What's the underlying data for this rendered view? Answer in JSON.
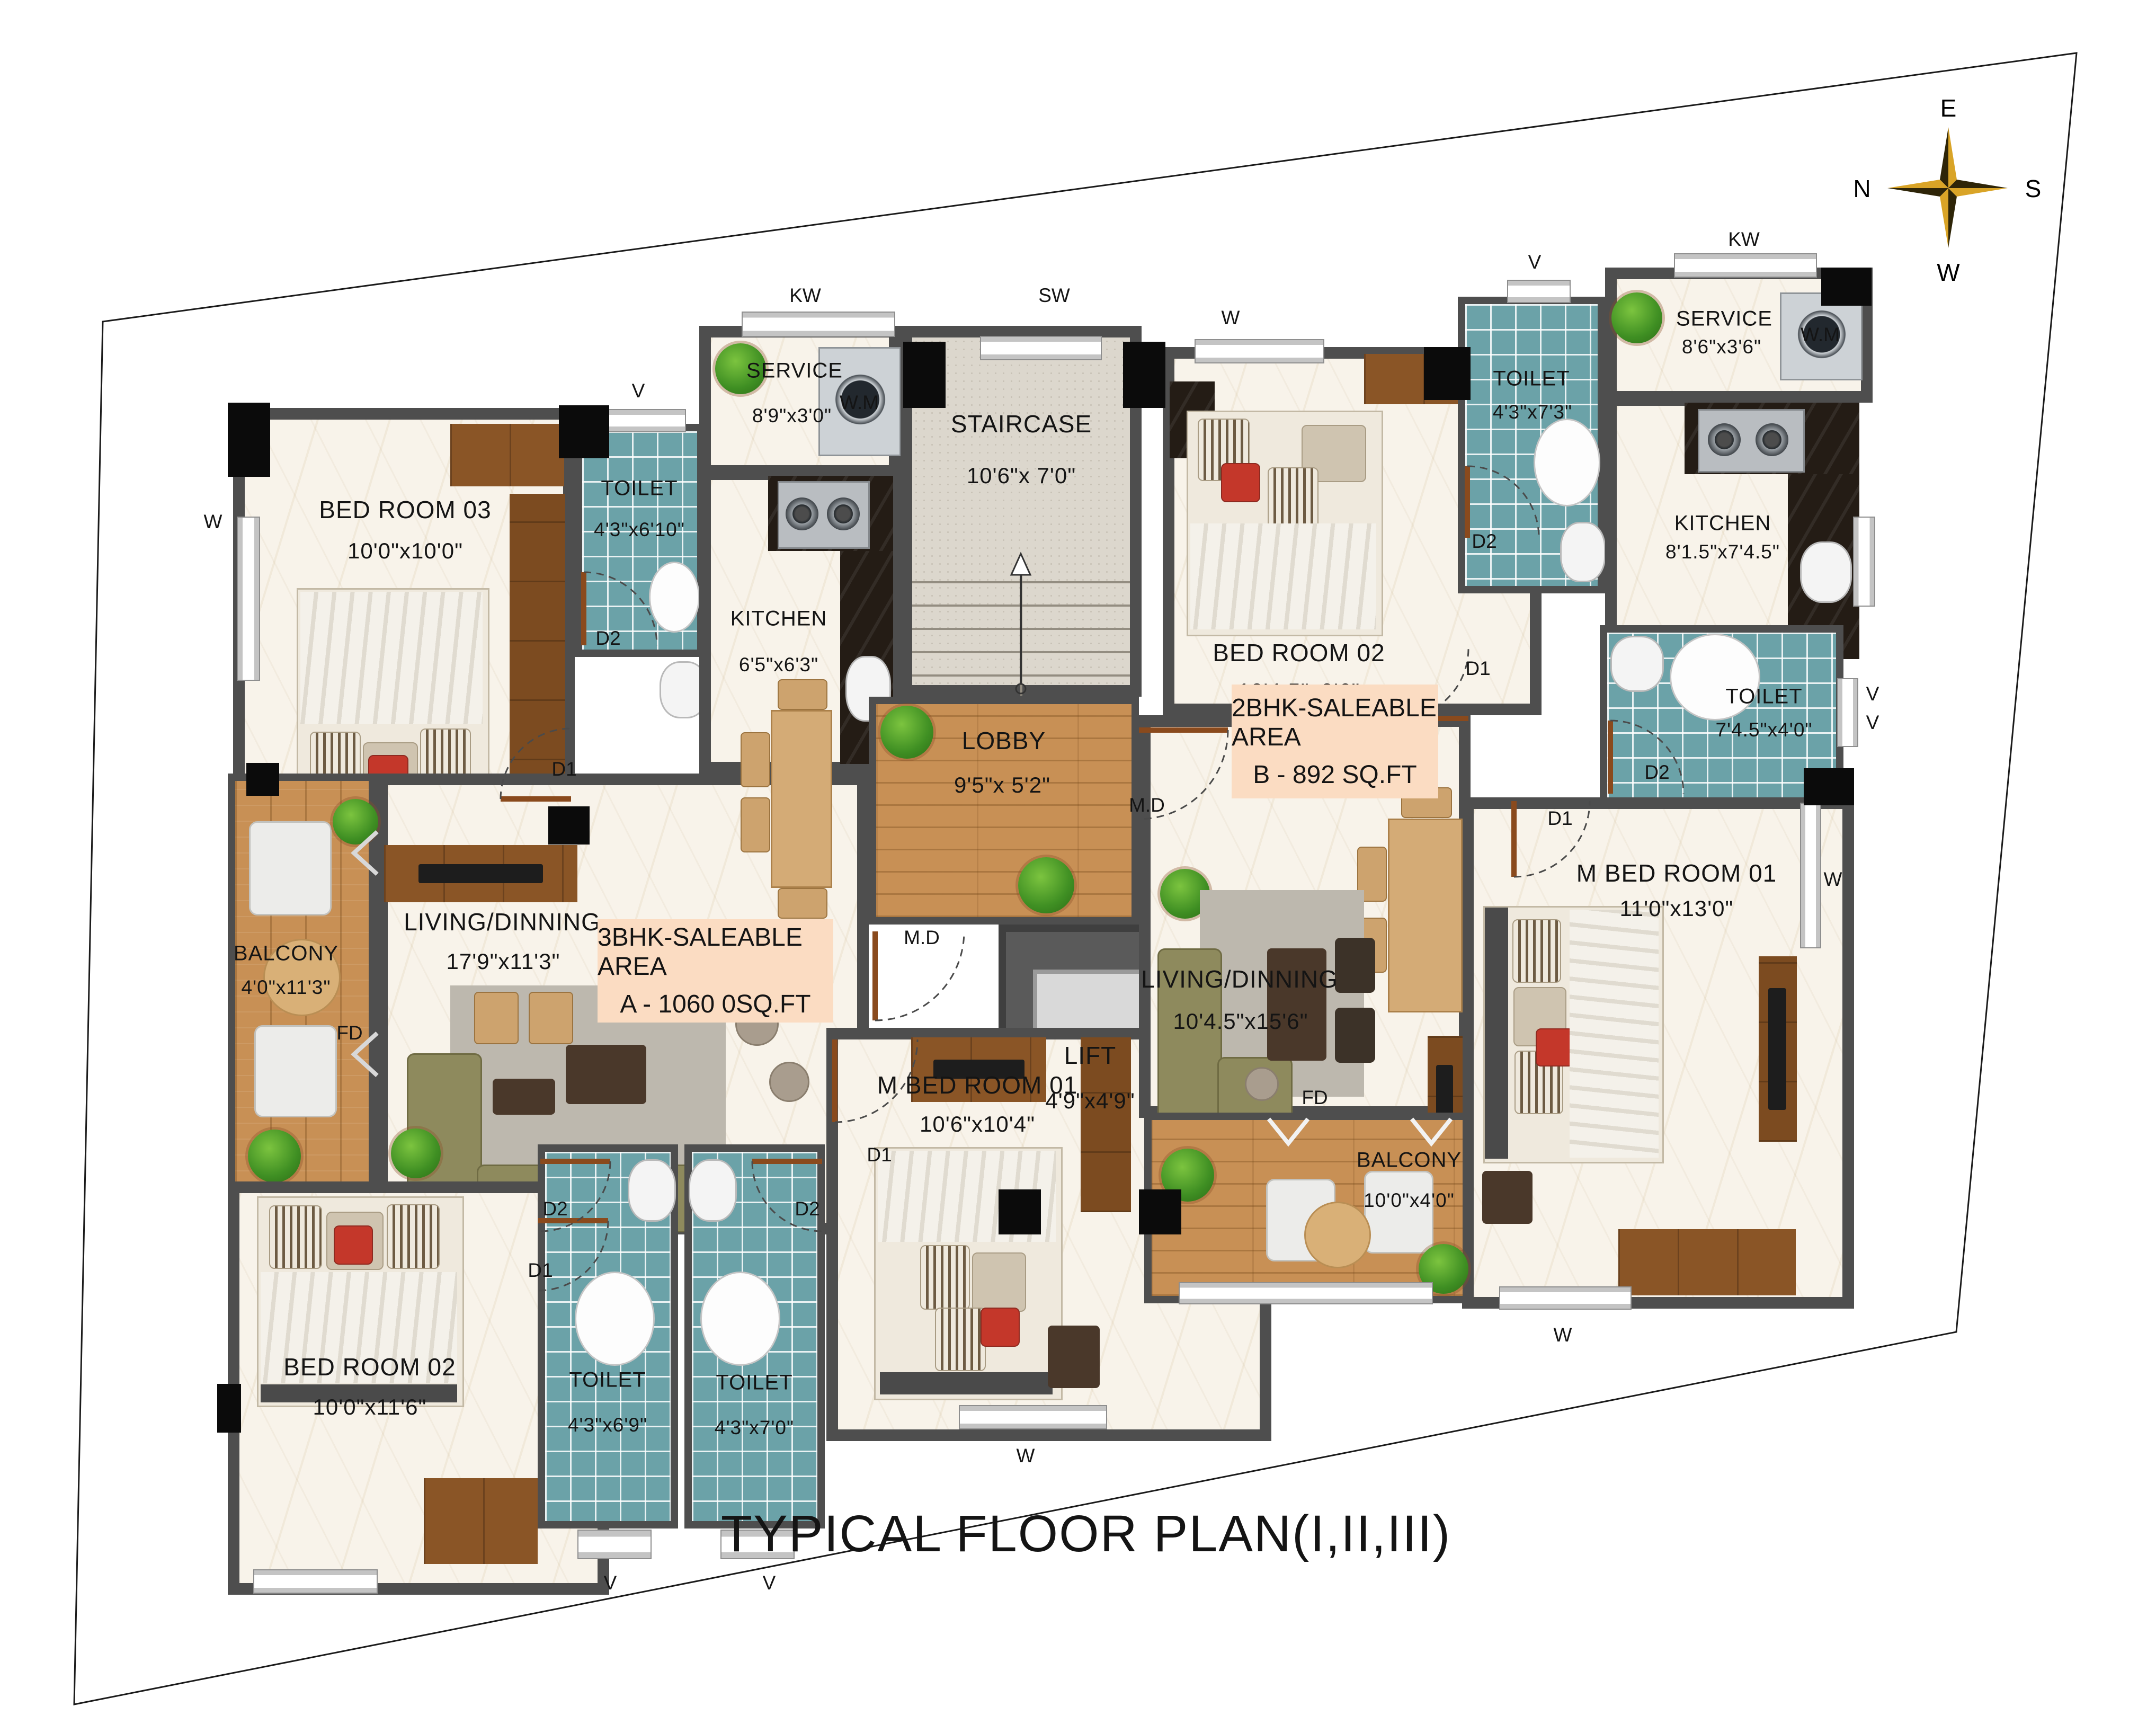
{
  "title": "TYPICAL FLOOR PLAN(I,II,III)",
  "compass": {
    "n": "N",
    "e": "E",
    "s": "S",
    "w": "W"
  },
  "area_boxes": {
    "a": {
      "line1": "3BHK-SALEABLE AREA",
      "line2": "A - 1060 0SQ.FT"
    },
    "b": {
      "line1": "2BHK-SALEABLE AREA",
      "line2": "B - 892 SQ.FT"
    }
  },
  "rooms": {
    "a_bed3": {
      "name": "BED ROOM 03",
      "dims": "10'0\"x10'0\""
    },
    "a_toilet1": {
      "name": "TOILET",
      "dims": "4'3\"x6'10\""
    },
    "a_service": {
      "name": "SERVICE",
      "dims": "8'9\"x3'0\""
    },
    "a_kitchen": {
      "name": "KITCHEN",
      "dims": "6'5\"x6'3\""
    },
    "staircase": {
      "name": "STAIRCASE",
      "dims": "10'6\"x 7'0\""
    },
    "lobby": {
      "name": "LOBBY",
      "dims": "9'5\"x 5'2\""
    },
    "lift": {
      "name": "LIFT",
      "dims": "4'9\"x4'9\""
    },
    "a_living": {
      "name": "LIVING/DINNING",
      "dims": "17'9\"x11'3\""
    },
    "a_balcony": {
      "name": "BALCONY",
      "dims": "4'0\"x11'3\""
    },
    "a_mbed": {
      "name": "M BED ROOM 01",
      "dims": "10'6\"x10'4\""
    },
    "a_bed2": {
      "name": "BED ROOM 02",
      "dims": "10'0\"x11'6\""
    },
    "a_toilet2": {
      "name": "TOILET",
      "dims": "4'3\"x6'9\""
    },
    "a_toilet3": {
      "name": "TOILET",
      "dims": "4'3\"x7'0\""
    },
    "b_bed2": {
      "name": "BED ROOM 02",
      "dims": "10'4.5\"x9'6\""
    },
    "b_toilet1": {
      "name": "TOILET",
      "dims": "4'3\"x7'3\""
    },
    "b_service": {
      "name": "SERVICE",
      "dims": "8'6\"x3'6\""
    },
    "b_kitchen": {
      "name": "KITCHEN",
      "dims": "8'1.5\"x7'4.5\""
    },
    "b_toilet2": {
      "name": "TOILET",
      "dims": "7'4.5\"x4'0\""
    },
    "b_living": {
      "name": "LIVING/DINNING",
      "dims": "10'4.5\"x15'6\""
    },
    "b_mbed": {
      "name": "M BED ROOM 01",
      "dims": "11'0\"x13'0\""
    },
    "b_balcony": {
      "name": "BALCONY",
      "dims": "10'0\"x4'0\""
    }
  },
  "tags": {
    "d1": "D1",
    "d2": "D2",
    "md": "M.D",
    "fd": "FD",
    "w": "W",
    "v": "V",
    "kw": "KW",
    "sw": "SW",
    "wm": "W.M"
  },
  "colors": {
    "wall": "#4e4e4e",
    "column": "#0b0b0b",
    "marble": "#f8f3ea",
    "tile_teal": "#6ba2a8",
    "wood": "#c89055",
    "granite": "#dcd7cd",
    "area_box": "#fbdcc2",
    "sofa": "#8e8a5d",
    "plant": "#3f8f23",
    "compass_gold": "#d9a427",
    "compass_dark": "#2e2508"
  }
}
